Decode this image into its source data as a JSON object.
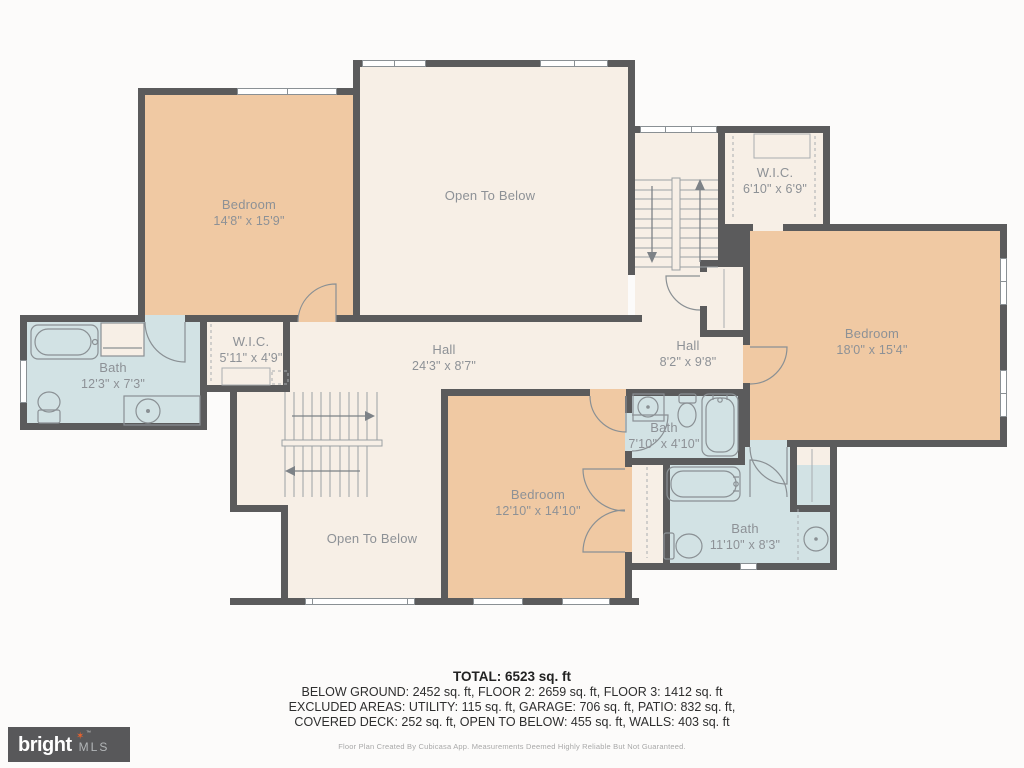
{
  "rooms": [
    {
      "label": "Bedroom",
      "dims": "14'8\" x 15'9\""
    },
    {
      "label": "Open To Below",
      "dims": ""
    },
    {
      "label": "W.I.C.",
      "dims": "6'10\" x 6'9\""
    },
    {
      "label": "Bedroom",
      "dims": "18'0\" x 15'4\""
    },
    {
      "label": "Hall",
      "dims": "24'3\" x 8'7\""
    },
    {
      "label": "Hall",
      "dims": "8'2\" x 9'8\""
    },
    {
      "label": "W.I.C.",
      "dims": "5'11\" x 4'9\""
    },
    {
      "label": "Bath",
      "dims": "12'3\" x 7'3\""
    },
    {
      "label": "Open To Below",
      "dims": ""
    },
    {
      "label": "Bedroom",
      "dims": "12'10\" x 14'10\""
    },
    {
      "label": "Bath",
      "dims": "7'10\" x 4'10\""
    },
    {
      "label": "Bath",
      "dims": "11'10\" x 8'3\""
    }
  ],
  "summary": {
    "total": "TOTAL: 6523 sq. ft",
    "line1": "BELOW GROUND: 2452 sq. ft, FLOOR 2: 2659 sq. ft, FLOOR 3: 1412 sq. ft",
    "line2": "EXCLUDED AREAS: UTILITY: 115 sq. ft, GARAGE: 706 sq. ft, PATIO: 832 sq. ft,",
    "line3": "COVERED DECK: 252 sq. ft, OPEN TO BELOW: 455 sq. ft, WALLS: 403 sq. ft",
    "disclaimer": "Floor Plan Created By Cubicasa App. Measurements Deemed Highly Reliable But Not Guaranteed."
  },
  "branding": {
    "name": "bright",
    "suffix": "MLS",
    "trademark": "TM"
  },
  "colors": {
    "room_fill_tan": "#f0c9a3",
    "room_fill_cream": "#f7efe6",
    "room_fill_blue": "#d2e2e4",
    "wall": "#5b5b5c",
    "background": "#fcfbfa",
    "logo_background": "#58585a",
    "logo_star": "#e8622d"
  }
}
